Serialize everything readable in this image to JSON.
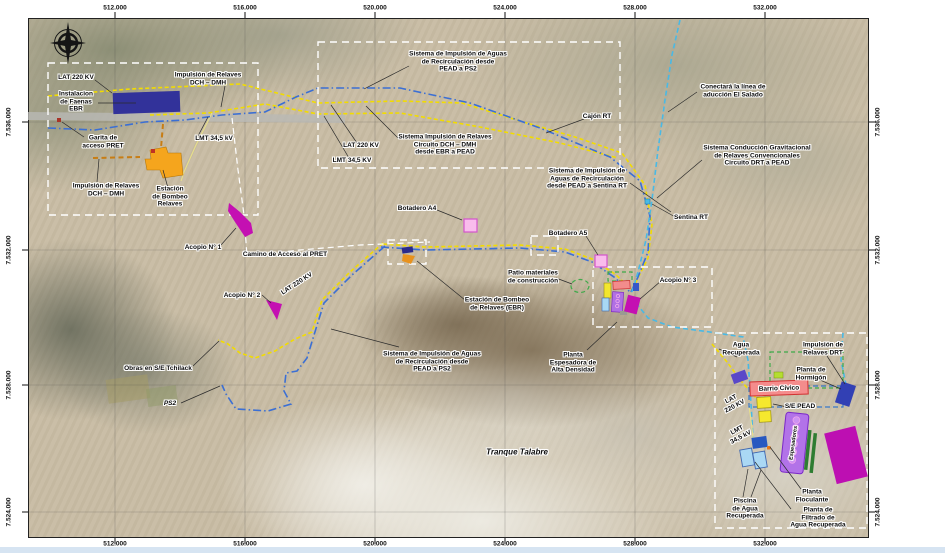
{
  "axis": {
    "top": [
      "512.000",
      "516.000",
      "520.000",
      "524.000",
      "528.000",
      "532.000"
    ],
    "bottom": [
      "512.000",
      "516.000",
      "520.000",
      "524.000",
      "528.000",
      "532.000"
    ],
    "left": [
      "7.536.000",
      "7.532.000",
      "7.528.000",
      "7.524.000"
    ],
    "right": [
      "7.536.000",
      "7.532.000",
      "7.528.000",
      "7.524.000"
    ]
  },
  "labels": {
    "lat220_nw": "LAT 220 KV",
    "imp_relaves_nw": "Impulsión de Relaves\nDCH – DMH",
    "instalacion_faenas": "Instalacion\nde Faenas\nEBR",
    "garita": "Garita de\nacceso PRET",
    "lmt_nw": "LMT 34,5 kV",
    "imp_relaves_sw": "Impulsión de Relaves\nDCH – DMH",
    "estacion_bombeo": "Estación\nde Bombeo\nRelaves",
    "acopio1": "Acopio N° 1",
    "camino": "Camino de Acceso al PRET",
    "acopio2": "Acopio N° 2",
    "lat220_mid": "LAT 220 KV",
    "obras": "Obras en S/E Tchilack",
    "ps2": "PS2",
    "sist_aguas_sw": "Sistema de Impulsión de Aguas\nde Recirculación desde\nPEAD a PS2",
    "sist_aguas_nc": "Sistema de Impulsión de Aguas\nde Recirculación desde\nPEAD a PS2",
    "lat220_inset": "LAT 220 KV",
    "sist_relaves_nc": "Sistema Impulsión de Relaves\nCircuito DCH – DMH\ndesde EBR a PEAD",
    "lmt_inset": "LMT 34,5 KV",
    "conectara": "Conectará la línea de\naducción El Salado",
    "cajon_rt": "Cajón RT",
    "conduccion": "Sistema Conducción Gravitacional\nde Relaves Convencionales\nCircuito DRT a PEAD",
    "sentina_rt": "Sentina RT",
    "sist_aguas_sentina": "Sistema de Impulsión de\nAguas de Recirculación\ndesde PEAD a Sentina RT",
    "botadero_a4": "Botadero A4",
    "botadero_a5": "Botadero A5",
    "patio": "Patio materiales\nde construcción",
    "estacion_ebr": "Estación de Bombeo\nde Relaves (EBR)",
    "acopio3": "Acopio N° 3",
    "planta_espesadora": "Planta\nEspesadora de\nAlta Densidad",
    "tranque": "Tranque Talabre",
    "agua_recuperada": "Agua\nRecuperada",
    "imp_drt": "Impulsión de\nRelaves DRT",
    "planta_hormigon": "Planta de\nHormigón",
    "barrio_civico": "Barrio Cívico",
    "se_pead": "S/E PEAD",
    "lat220_br": "LAT\n220 KV",
    "lmt_br": "LMT\n34,5 kV",
    "espesadores": "Espesadores",
    "piscina": "Piscina\nde Agua\nRecuperada",
    "floculante": "Planta\nFloculante",
    "filtrado": "Planta de\nFiltrado de\nAgua Recuperada"
  },
  "colors": {
    "lat_line": "#F2DC00",
    "recirculacion_line": "#3B6FD4",
    "sentina_line": "#49B9E5",
    "relaves_line": "#C87D14",
    "acopio_fill": "#C410B2",
    "botadero_fill": "#F9BCEC",
    "inset_border": "#FFFFFF",
    "barrio_fill": "#F48C8C",
    "espesadores_fill": "#B273E8"
  }
}
